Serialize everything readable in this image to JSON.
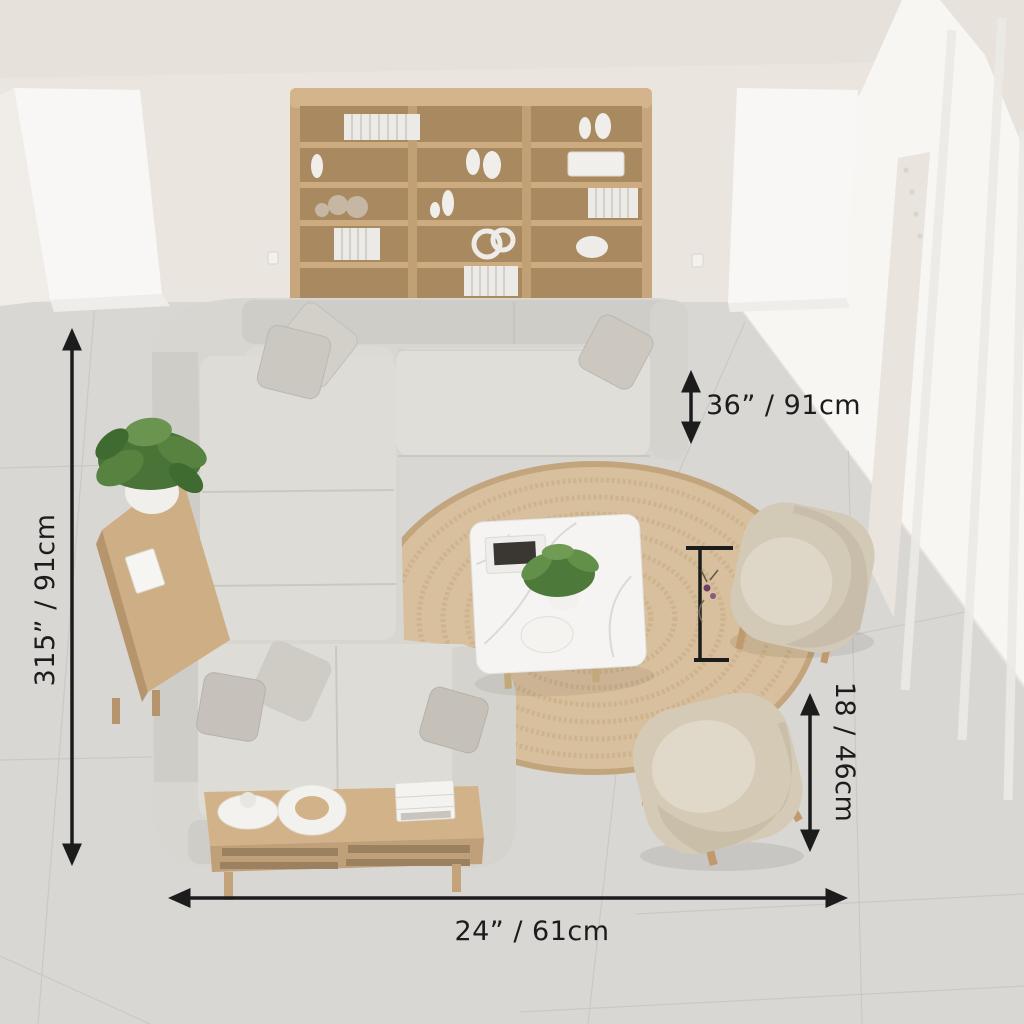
{
  "annotations": {
    "left_height": {
      "label": "315” / 91cm",
      "orientation": "vertical-left",
      "arrow": "double-vertical"
    },
    "sofa_height": {
      "label": "36” / 91cm",
      "orientation": "horizontal",
      "arrow": "double-vertical"
    },
    "side_height": {
      "label": "18 / 46cm",
      "orientation": "vertical-right",
      "arrow": "double-vertical"
    },
    "bottom_width": {
      "label": "24” / 61cm",
      "orientation": "horizontal",
      "arrow": "double-horizontal"
    }
  },
  "colors": {
    "wall": "#eae5de",
    "window_light": "#f9f8f5",
    "floor": "#d9d7d3",
    "grout": "#c8c6c2",
    "annotation": "#1c1c1c",
    "wood_shelf": "#c7a67d",
    "wood_shelf_back": "#a9895f",
    "sofa_body": "#d8d6d1",
    "sofa_seat": "#e0ded9",
    "sofa_back": "#cfcdc8",
    "rug": "#d8bf9d",
    "rug_ring": "#c9ad85",
    "armchair": "#d4cab6",
    "coffee_table_white": "#f5f4f2",
    "wood_table": "#d2b389",
    "plant_green": "#4e7a3d",
    "leg_wood": "#c09a6c"
  },
  "objects": {
    "bookshelf": "wooden open bookshelf with white books and vases",
    "sofa": "u-shaped light grey sectional sofa with cushions",
    "rug": "round braided jute rug",
    "coffee_table_white": "white marble coffee table with fern plant, book and bowl",
    "armchair_top": "beige upholstered armchair",
    "armchair_bottom": "beige upholstered armchair",
    "console_table": "wooden console with potted plant and photo frame",
    "wood_coffee_table": "low oak coffee table with cone vase, ring vase and books",
    "window_left": "tall bright window",
    "window_back": "tall bright window",
    "window_right": "floor-to-ceiling windows with sheer curtains"
  }
}
